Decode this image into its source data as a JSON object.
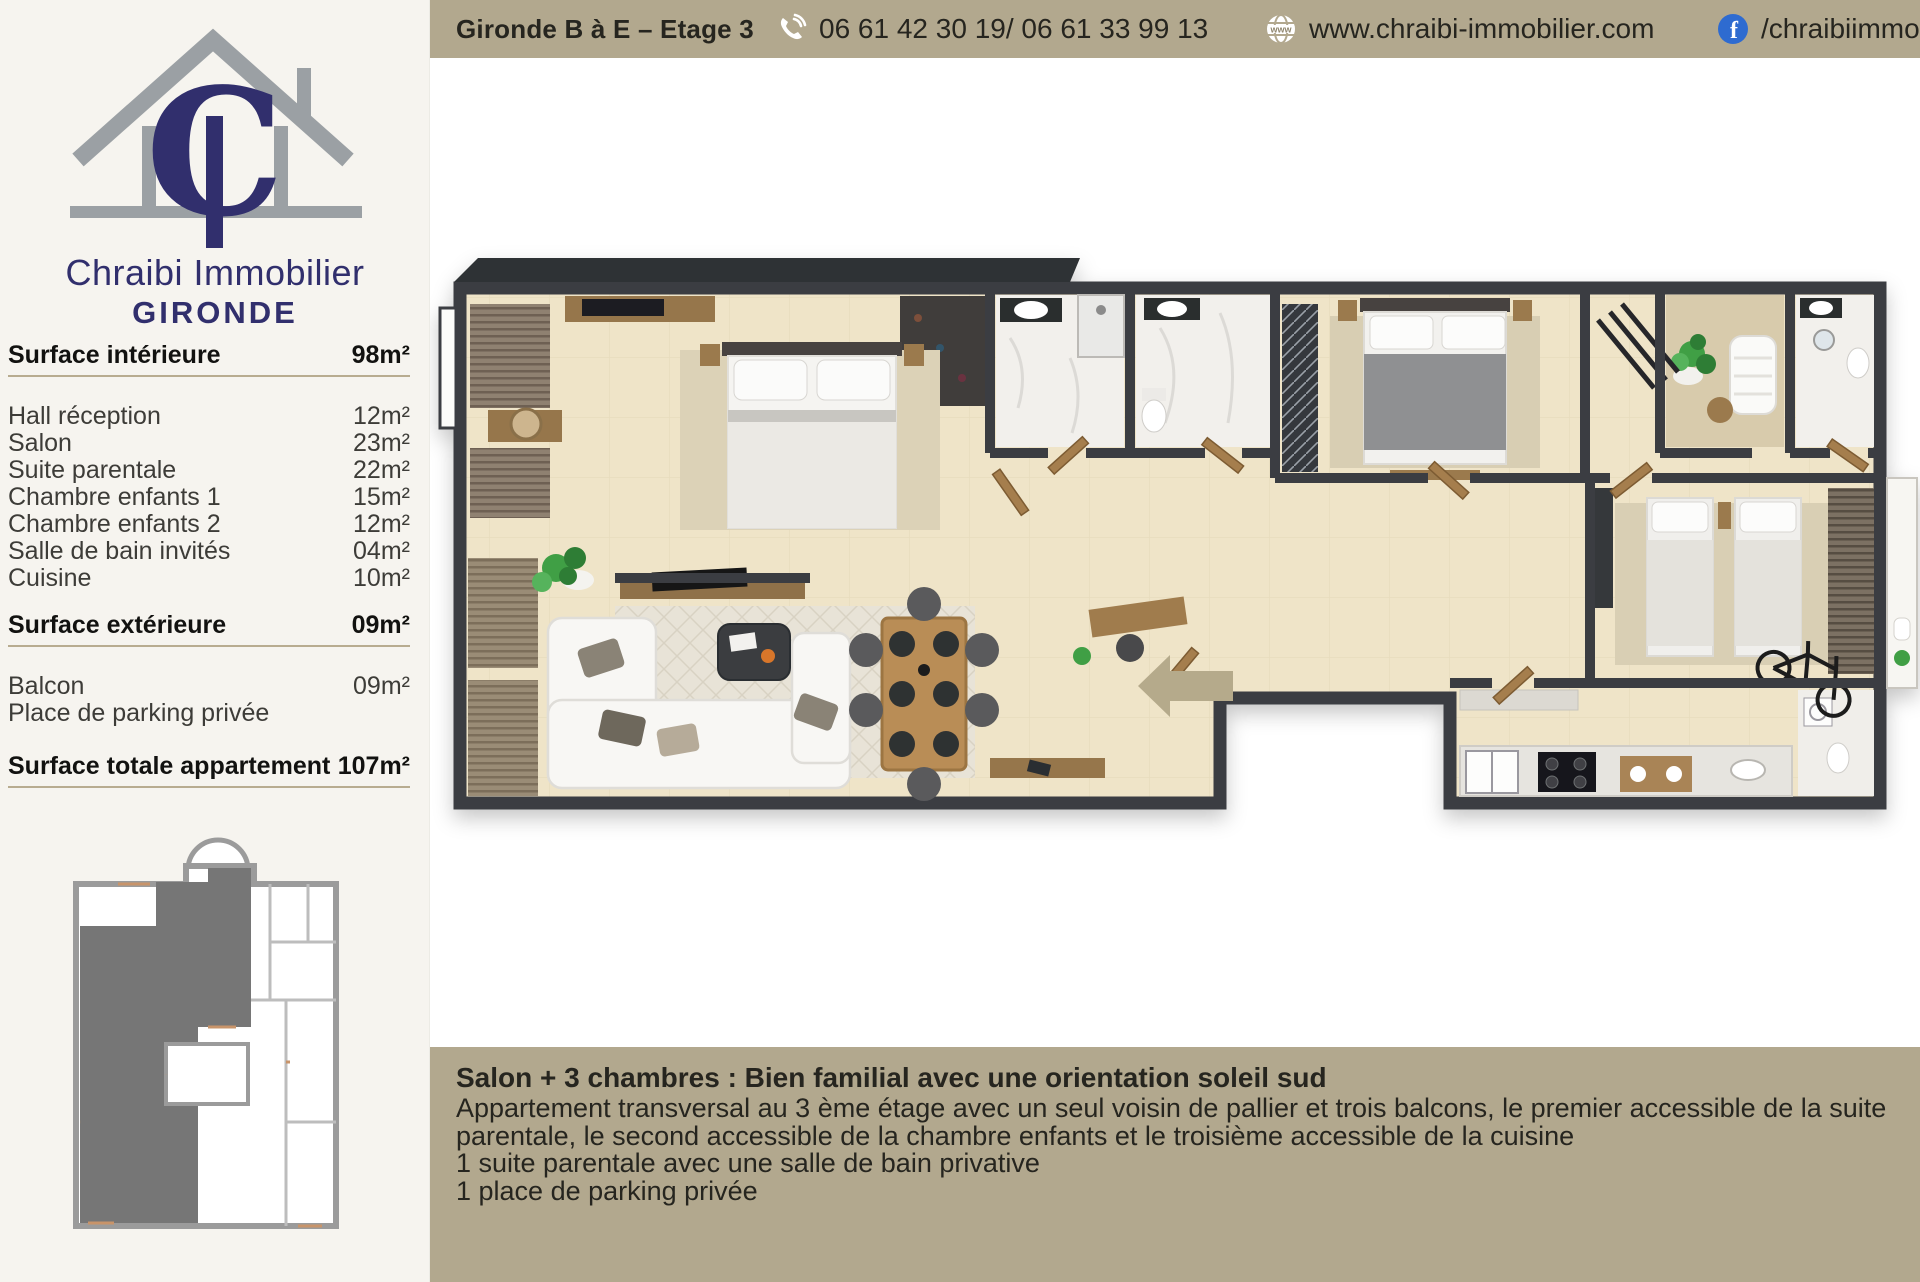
{
  "sidebar": {
    "brand": {
      "name": "Chraibi Immobilier",
      "region": "GIRONDE"
    },
    "sections": {
      "interior": {
        "label": "Surface intérieure",
        "value": "98m²"
      },
      "interior_rows": [
        {
          "label": "Hall réception",
          "value": "12m²"
        },
        {
          "label": "Salon",
          "value": "23m²"
        },
        {
          "label": "Suite parentale",
          "value": "22m²"
        },
        {
          "label": "Chambre enfants 1",
          "value": "15m²"
        },
        {
          "label": "Chambre enfants 2",
          "value": "12m²"
        },
        {
          "label": "Salle de bain invités",
          "value": "04m²"
        },
        {
          "label": "Cuisine",
          "value": "10m²"
        }
      ],
      "exterior": {
        "label": "Surface extérieure",
        "value": "09m²"
      },
      "exterior_rows": [
        {
          "label": "Balcon",
          "value": "09m²"
        },
        {
          "label": "Place de parking privée",
          "value": ""
        }
      ],
      "total": {
        "label": "Surface totale appartement",
        "value": "107m²"
      }
    }
  },
  "header": {
    "title": "Gironde B à E – Etage 3",
    "phone": "06 61 42 30 19/ 06 61 33 99 13",
    "website": "www.chraibi-immobilier.com",
    "facebook_handle": "/chraibiimmobilier",
    "globe_label": "www",
    "facebook_letter": "f"
  },
  "footer": {
    "title": "Salon + 3 chambres : Bien familial avec une orientation soleil sud",
    "body": "Appartement transversal au 3 ème étage avec un seul voisin de pallier et trois balcons, le premier accessible de la suite parentale, le second accessible de la chambre enfants et le troisième accessible de la cuisine",
    "line2": "1 suite parentale avec une salle de bain privative",
    "line3": "1 place de parking privée"
  },
  "colors": {
    "bar_background": "#b2a88e",
    "brand_navy": "#312f6d",
    "logo_gray": "#9ba0a4",
    "facebook_blue": "#2e6bd0",
    "wall": "#3a3d42",
    "floor": "#efe4c8",
    "entrance_arrow": "#b5aa8b",
    "sidebar_background": "#f6f4ef"
  }
}
